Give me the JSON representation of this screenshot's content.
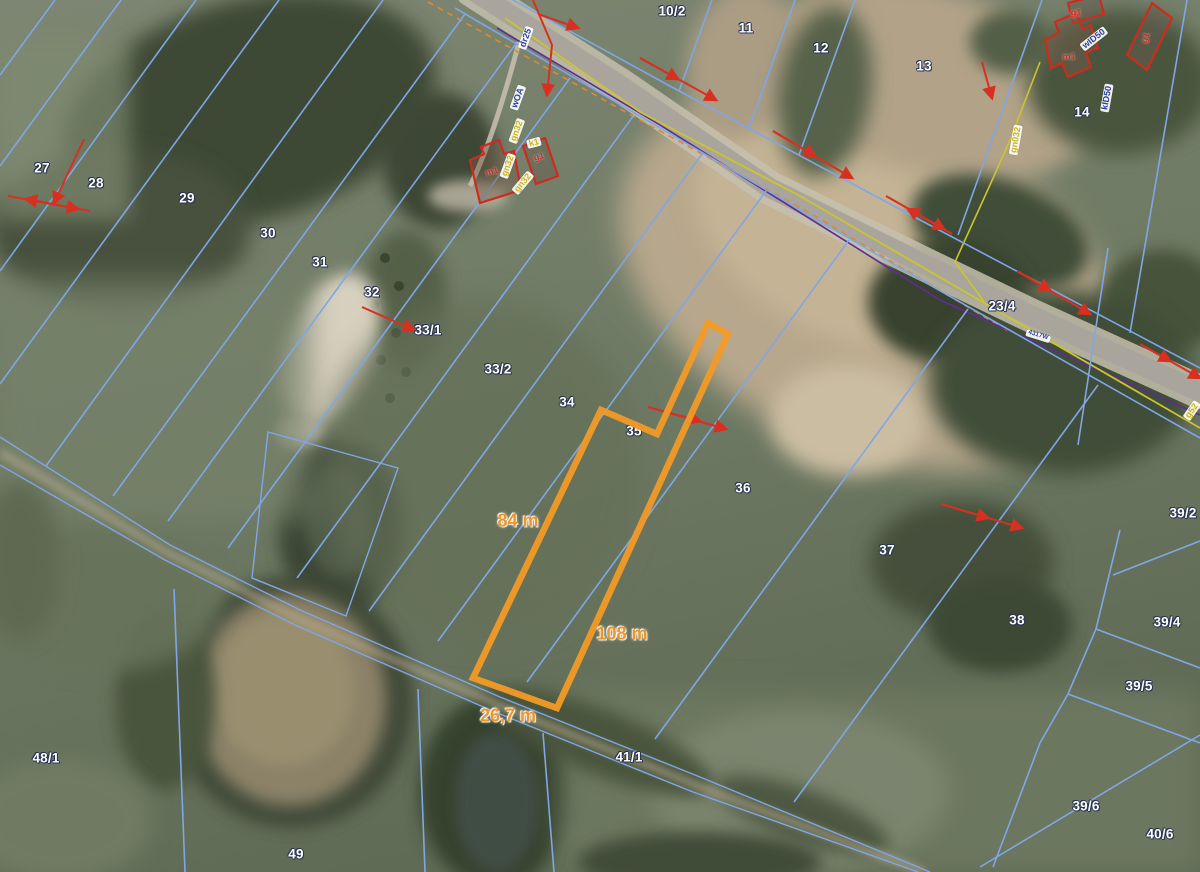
{
  "map": {
    "description": "Aerial cadastral map with parcel boundaries and a highlighted parcel",
    "colors": {
      "parcel_line": "#7fa6e6",
      "highlight": "#f29a27",
      "survey_marker": "#d83020",
      "building_outline": "#cf2b1d",
      "gas_line": "#cbc52e",
      "telecom_line": "#5b2f92",
      "label_text": "#ffffff",
      "label_outline": "#2a3550",
      "utility_text_navy": "#2b3f9d",
      "utility_text_yellow": "#c8b517"
    },
    "parcel_labels": [
      {
        "id": "27",
        "x": 42,
        "y": 168
      },
      {
        "id": "28",
        "x": 96,
        "y": 183
      },
      {
        "id": "29",
        "x": 187,
        "y": 198
      },
      {
        "id": "30",
        "x": 268,
        "y": 233
      },
      {
        "id": "31",
        "x": 320,
        "y": 262
      },
      {
        "id": "32",
        "x": 372,
        "y": 292
      },
      {
        "id": "33/1",
        "x": 428,
        "y": 330
      },
      {
        "id": "33/2",
        "x": 498,
        "y": 369
      },
      {
        "id": "34",
        "x": 567,
        "y": 402
      },
      {
        "id": "35",
        "x": 634,
        "y": 431
      },
      {
        "id": "10/2",
        "x": 672,
        "y": 11
      },
      {
        "id": "11",
        "x": 746,
        "y": 28
      },
      {
        "id": "12",
        "x": 821,
        "y": 48
      },
      {
        "id": "13",
        "x": 924,
        "y": 66
      },
      {
        "id": "14",
        "x": 1082,
        "y": 112
      },
      {
        "id": "23/4",
        "x": 1002,
        "y": 306
      },
      {
        "id": "36",
        "x": 743,
        "y": 488
      },
      {
        "id": "37",
        "x": 887,
        "y": 550
      },
      {
        "id": "38",
        "x": 1017,
        "y": 620
      },
      {
        "id": "39/2",
        "x": 1183,
        "y": 513
      },
      {
        "id": "39/4",
        "x": 1167,
        "y": 622
      },
      {
        "id": "39/5",
        "x": 1139,
        "y": 686
      },
      {
        "id": "39/6",
        "x": 1086,
        "y": 806
      },
      {
        "id": "40/6",
        "x": 1160,
        "y": 834
      },
      {
        "id": "41/1",
        "x": 629,
        "y": 757
      },
      {
        "id": "48/1",
        "x": 46,
        "y": 758
      },
      {
        "id": "49",
        "x": 296,
        "y": 854
      }
    ],
    "measurements": [
      {
        "text": "84 m",
        "x": 518,
        "y": 521
      },
      {
        "text": "108 m",
        "x": 622,
        "y": 634
      },
      {
        "text": "26,7 m",
        "x": 508,
        "y": 716
      }
    ],
    "utility_labels": [
      {
        "text": "dr25",
        "x": 526,
        "y": 38,
        "rot": -70,
        "style": "navy",
        "boxed": true
      },
      {
        "text": "wOA",
        "x": 518,
        "y": 98,
        "rot": -70,
        "style": "navy",
        "boxed": true
      },
      {
        "text": "gn32",
        "x": 517,
        "y": 131,
        "rot": -70,
        "style": "yellow",
        "boxed": true
      },
      {
        "text": "k1",
        "x": 534,
        "y": 143,
        "rot": -15,
        "style": "yellow",
        "boxed": true
      },
      {
        "text": "gn32",
        "x": 508,
        "y": 166,
        "rot": -70,
        "style": "yellow",
        "boxed": true
      },
      {
        "text": "gn32",
        "x": 523,
        "y": 183,
        "rot": -50,
        "style": "yellow",
        "boxed": true
      },
      {
        "text": "wID50",
        "x": 1094,
        "y": 39,
        "rot": -38,
        "style": "navy",
        "boxed": true
      },
      {
        "text": "kID50",
        "x": 1107,
        "y": 98,
        "rot": -80,
        "style": "navy",
        "boxed": true
      },
      {
        "text": "gn032",
        "x": 1016,
        "y": 140,
        "rot": -80,
        "style": "yellow",
        "boxed": true
      },
      {
        "text": "g52",
        "x": 1192,
        "y": 411,
        "rot": -55,
        "style": "yellow",
        "boxed": true
      },
      {
        "text": "4317W",
        "x": 1038,
        "y": 336,
        "rot": 17,
        "style": "navy tiny",
        "boxed": true
      }
    ],
    "building_labels": [
      {
        "text": "m1",
        "x": 492,
        "y": 172,
        "rot": -15,
        "style": "red",
        "boxed": false
      },
      {
        "text": "g1",
        "x": 539,
        "y": 157,
        "rot": -15,
        "style": "red",
        "boxed": false
      },
      {
        "text": "g1",
        "x": 1076,
        "y": 13,
        "rot": 0,
        "style": "red",
        "boxed": false
      },
      {
        "text": "m1",
        "x": 1069,
        "y": 57,
        "rot": 0,
        "style": "red",
        "boxed": false
      },
      {
        "text": "g1",
        "x": 1146,
        "y": 38,
        "rot": -70,
        "style": "red",
        "boxed": false
      }
    ]
  }
}
